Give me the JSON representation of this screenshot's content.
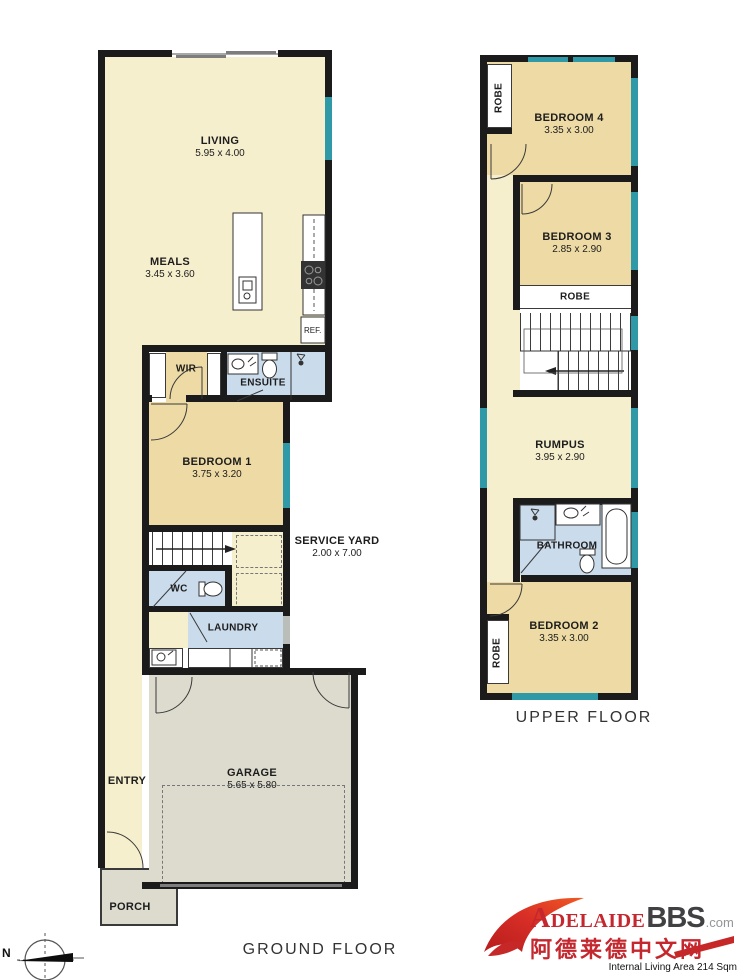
{
  "ground_floor": {
    "title": "GROUND FLOOR",
    "rooms": {
      "living": {
        "name": "LIVING",
        "dims": "5.95 x 4.00"
      },
      "meals": {
        "name": "MEALS",
        "dims": "3.45 x 3.60"
      },
      "wir": {
        "name": "WIR"
      },
      "ensuite": {
        "name": "ENSUITE"
      },
      "bedroom1": {
        "name": "BEDROOM 1",
        "dims": "3.75 x 3.20"
      },
      "service_yard": {
        "name": "SERVICE YARD",
        "dims": "2.00 x 7.00"
      },
      "wc": {
        "name": "WC"
      },
      "laundry": {
        "name": "LAUNDRY"
      },
      "entry": {
        "name": "ENTRY"
      },
      "garage": {
        "name": "GARAGE",
        "dims": "5.65 x 5.80"
      },
      "porch": {
        "name": "PORCH"
      },
      "fridge": {
        "name": "REF."
      }
    }
  },
  "upper_floor": {
    "title": "UPPER FLOOR",
    "rooms": {
      "robe4": {
        "name": "ROBE"
      },
      "bedroom4": {
        "name": "BEDROOM 4",
        "dims": "3.35 x 3.00"
      },
      "bedroom3": {
        "name": "BEDROOM 3",
        "dims": "2.85 x 2.90"
      },
      "robe3": {
        "name": "ROBE"
      },
      "rumpus": {
        "name": "RUMPUS",
        "dims": "3.95 x 2.90"
      },
      "bathroom": {
        "name": "BATHROOM"
      },
      "bedroom2": {
        "name": "BEDROOM 2",
        "dims": "3.35 x 3.00"
      },
      "robe2": {
        "name": "ROBE"
      }
    }
  },
  "compass": {
    "north_label": "N"
  },
  "branding": {
    "brand_main": "ADELAIDE",
    "brand_bbs": "BBS",
    "brand_tld": ".com",
    "chinese_name": "阿德莱德中文网",
    "area_note": "Internal Living Area 214 Sqm"
  },
  "colors": {
    "floor_cream": "#f6efcd",
    "bedroom_tan": "#eddaa4",
    "wet_area_blue": "#cadbeb",
    "garage_grey": "#dddbce",
    "window_teal": "#2f99a7",
    "wall_black": "#1b1b1b",
    "brand_red": "#c4272e"
  }
}
